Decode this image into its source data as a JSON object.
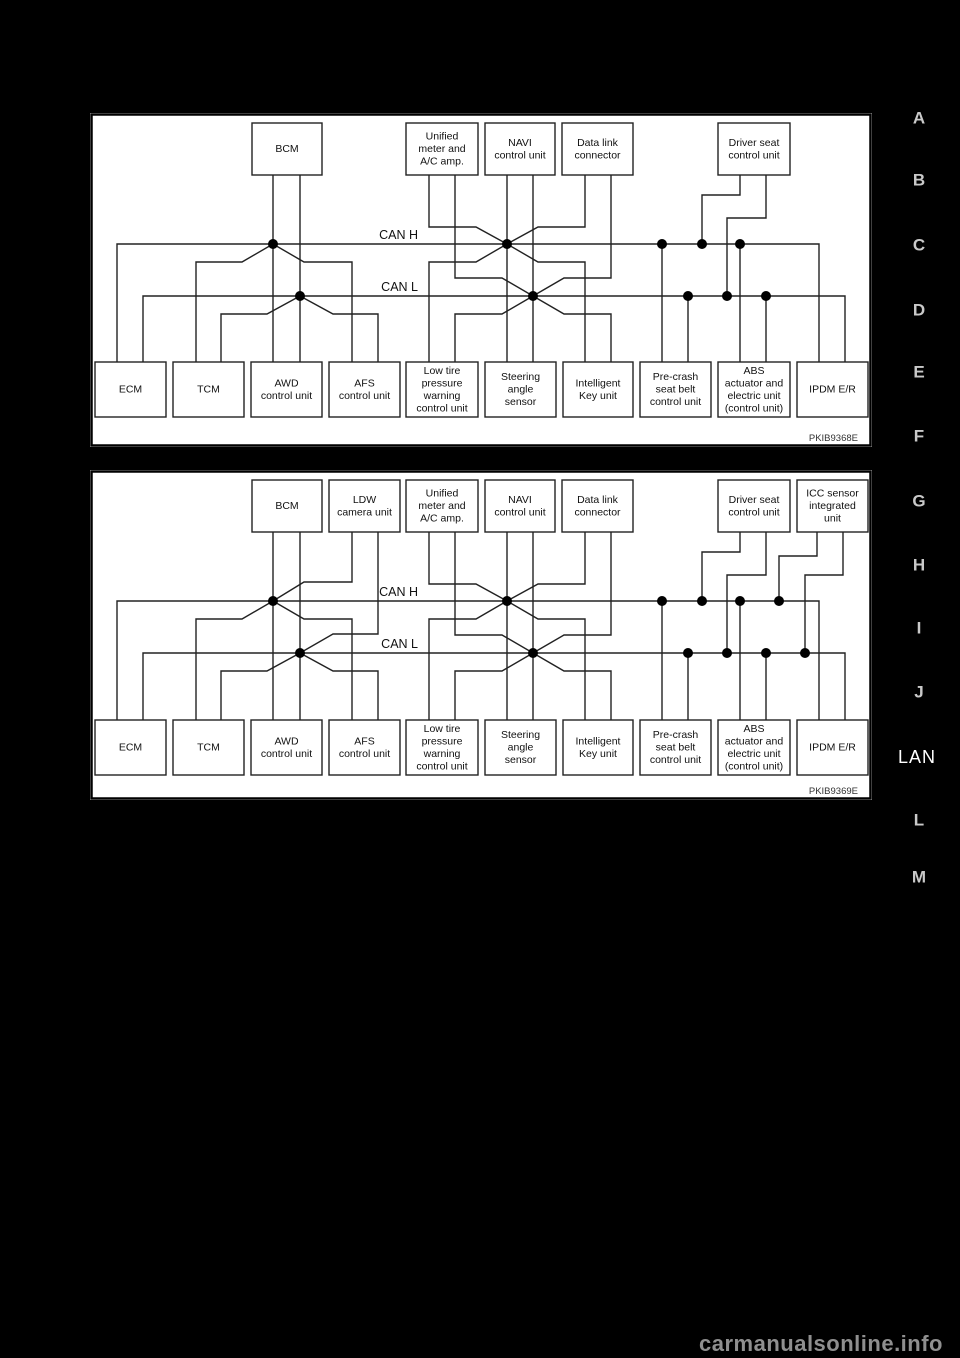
{
  "page": {
    "background": "#000000",
    "watermark": "carmanualsonline.info",
    "side_index": {
      "letters": [
        "A",
        "B",
        "C",
        "D",
        "E",
        "F",
        "G",
        "H",
        "I",
        "J",
        "L",
        "M"
      ],
      "section_label": "LAN"
    }
  },
  "colors": {
    "panel_background": "#ffffff",
    "line": "#222222",
    "dot": "#000000",
    "box_text": "#111111",
    "figure_code_text": "#333333",
    "index_letter": "#c9c9c9",
    "section_label": "#ffffff",
    "watermark": "#8f8f8f"
  },
  "diagrams": [
    {
      "figure_code": "PKIB9368E",
      "bus_labels": {
        "high": "CAN H",
        "low": "CAN L"
      },
      "top_boxes": [
        "BCM",
        "Unified\nmeter and\nA/C amp.",
        "NAVI\ncontrol unit",
        "Data link\nconnector",
        "Driver seat\ncontrol unit"
      ],
      "bottom_boxes": [
        "ECM",
        "TCM",
        "AWD\ncontrol unit",
        "AFS\ncontrol unit",
        "Low tire\npressure\nwarning\ncontrol unit",
        "Steering\nangle\nsensor",
        "Intelligent\nKey unit",
        "Pre-crash\nseat belt\ncontrol unit",
        "ABS\nactuator and\nelectric unit\n(control unit)",
        "IPDM E/R"
      ]
    },
    {
      "figure_code": "PKIB9369E",
      "bus_labels": {
        "high": "CAN H",
        "low": "CAN L"
      },
      "top_boxes": [
        "BCM",
        "LDW\ncamera unit",
        "Unified\nmeter and\nA/C amp.",
        "NAVI\ncontrol unit",
        "Data link\nconnector",
        "Driver seat\ncontrol unit",
        "ICC sensor\nintegrated\nunit"
      ],
      "bottom_boxes": [
        "ECM",
        "TCM",
        "AWD\ncontrol unit",
        "AFS\ncontrol unit",
        "Low tire\npressure\nwarning\ncontrol unit",
        "Steering\nangle\nsensor",
        "Intelligent\nKey unit",
        "Pre-crash\nseat belt\ncontrol unit",
        "ABS\nactuator and\nelectric unit\n(control unit)",
        "IPDM E/R"
      ]
    }
  ]
}
